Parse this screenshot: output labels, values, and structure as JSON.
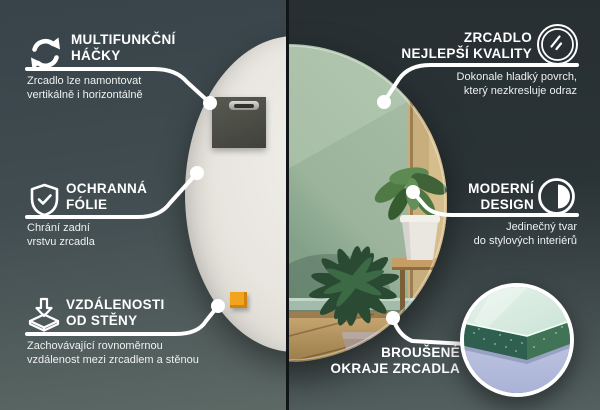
{
  "infographic": {
    "language": "cs",
    "subject": "round mirror product features"
  },
  "colors": {
    "background_left_top": "#38434a",
    "background_left_bottom": "#5d6965",
    "background_right_top": "#272f32",
    "background_right_bottom": "#546060",
    "divider": "#111517",
    "text": "#ffffff",
    "mirror_back": "#e9e6e1",
    "felt_pad": "#4a4c44",
    "orange_spacer": "#f2a41c",
    "reflection_wall_green": "#88a48d",
    "reflection_floor_wood": "#b2925f",
    "glass_edge_green": "#2f5f4e",
    "inset_background_lavender": "#c0c7e2"
  },
  "callouts": {
    "hooks": {
      "icon": "rotate-arrows-icon",
      "title": [
        "MULTIFUNKČNÍ",
        "HÁČKY"
      ],
      "desc": [
        "Zrcadlo lze namontovat",
        "vertikálně i horizontálně"
      ]
    },
    "foil": {
      "icon": "shield-check-icon",
      "title": [
        "OCHRANNÁ",
        "FÓLIE"
      ],
      "desc": [
        "Chrání zadní",
        "vrstvu zrcadla"
      ]
    },
    "distance": {
      "icon": "wall-distance-icon",
      "title": [
        "VZDÁLENOSTI",
        "OD STĚNY"
      ],
      "desc": [
        "Zachovávající rovnoměrnou",
        "vzdálenost mezi zrcadlem a stěnou"
      ]
    },
    "quality": {
      "icon": "mirror-shine-icon",
      "title": [
        "ZRCADLO",
        "NEJLEPŠÍ KVALITY"
      ],
      "desc": [
        "Dokonale hladký povrch,",
        "který nezkresluje odraz"
      ]
    },
    "design": {
      "icon": "contrast-circle-icon",
      "title": [
        "MODERNÍ",
        "DESIGN"
      ],
      "desc": [
        "Jedinečný tvar",
        "do stylových interiérů"
      ]
    },
    "edges": {
      "icon": "glass-edge-photo",
      "title": [
        "BROUŠENÉ",
        "OKRAJE ZRCADLA"
      ],
      "desc": []
    }
  }
}
